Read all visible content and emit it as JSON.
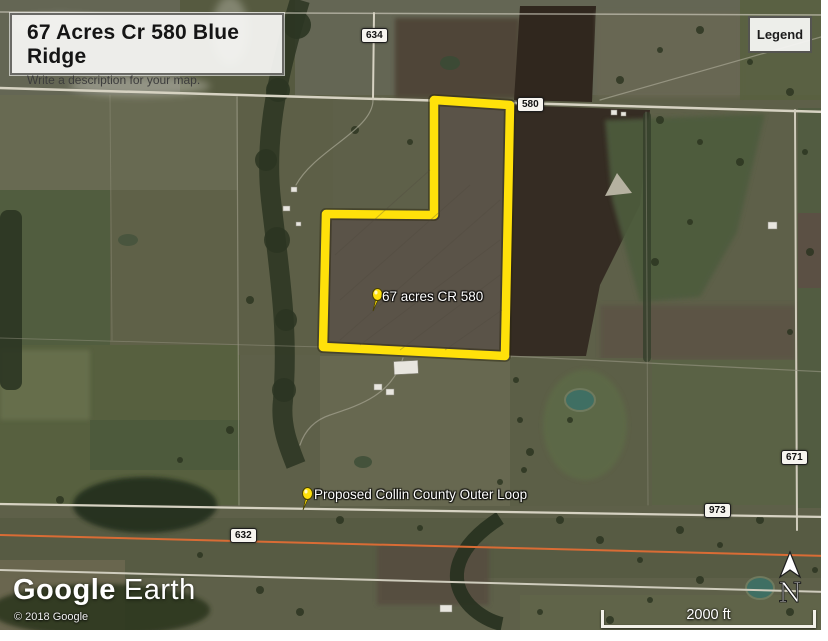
{
  "map": {
    "title": "67 Acres Cr 580 Blue Ridge",
    "description_placeholder": "Write a description for your map.",
    "legend": {
      "label": "Legend"
    },
    "placemarks": [
      {
        "label": "67 acres CR 580"
      },
      {
        "label": "Proposed Collin County Outer Loop"
      }
    ],
    "road_markers": [
      {
        "label": "634"
      },
      {
        "label": "580"
      },
      {
        "label": "671"
      },
      {
        "label": "973"
      },
      {
        "label": "632"
      }
    ],
    "scale_bar": {
      "label": "2000 ft"
    },
    "compass": {
      "label": "N"
    },
    "attribution": {
      "logo_primary": "Google",
      "logo_secondary": "Earth",
      "copyright": "© 2018 Google"
    },
    "colors": {
      "parcel_outline_yellow": "#ffe10a",
      "placemark_pin_yellow": "#ffe10a",
      "proposed_route_orange": "#d96c35",
      "plowed_field_brown": "#352c23"
    }
  }
}
